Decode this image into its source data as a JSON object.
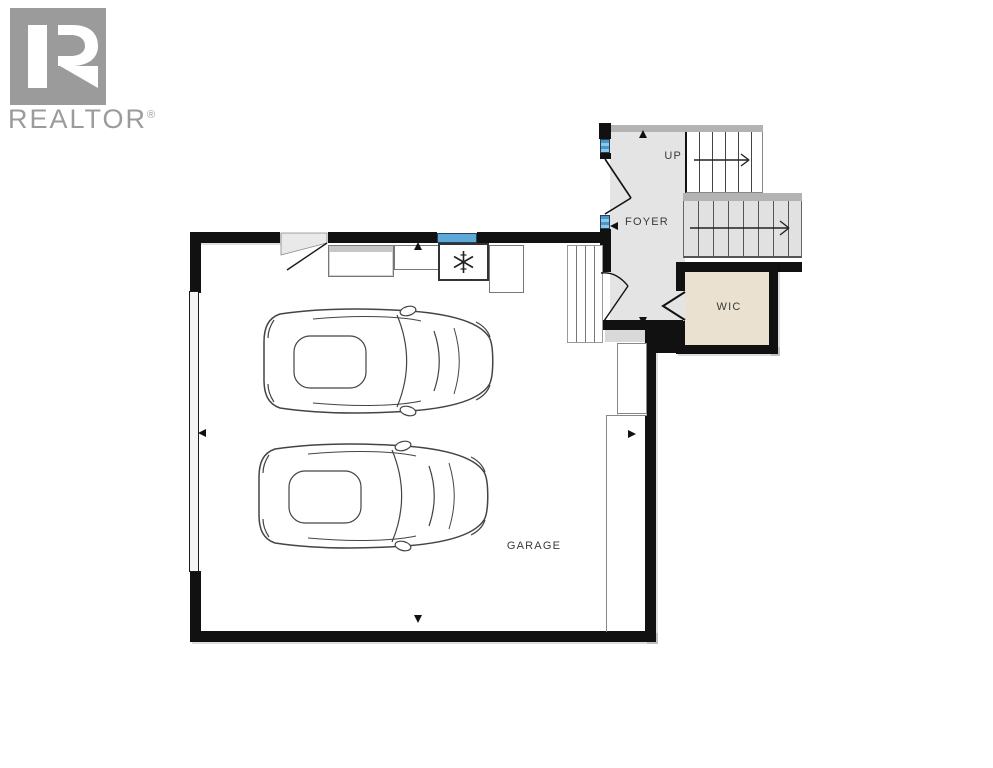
{
  "logo": {
    "brand": "REALTOR",
    "registered": "®",
    "color": "#9b9b9b"
  },
  "floorplan": {
    "labels": {
      "up": "UP",
      "foyer": "FOYER",
      "wic": "WIC",
      "garage": "GARAGE"
    },
    "colors": {
      "wall": "#111111",
      "foyer_floor": "#e4e4e4",
      "wic_floor": "#eae1d0",
      "stair_tread_fill": "#e1e1e1",
      "stair_cap": "#b3b3b3",
      "window": "#5fa9d9",
      "landing": "#d9d9d9",
      "linework": "#444444"
    },
    "stairs": {
      "label": "UP",
      "upper_flight_treads": 6,
      "lower_flight_treads": 8
    },
    "icons": [
      "snowflake-icon",
      "car-top-view-icon",
      "door-swing-icon",
      "bifold-door-icon",
      "direction-arrow-icon",
      "window-marker",
      "realtor-r-mark"
    ]
  }
}
